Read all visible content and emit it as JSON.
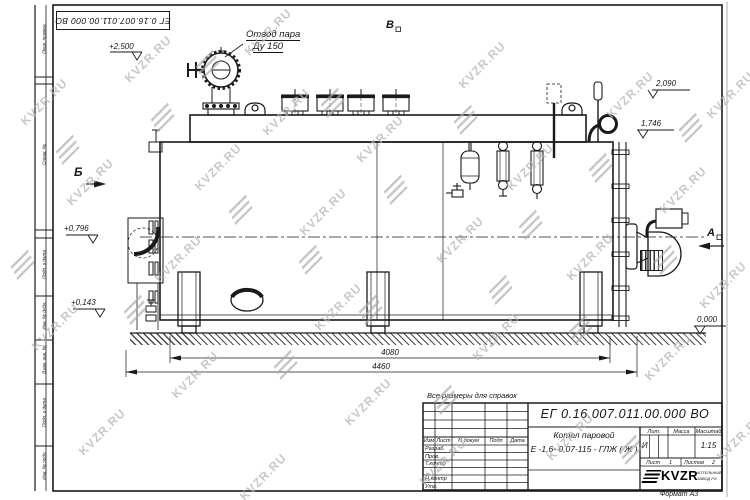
{
  "page": {
    "format": "Формат  А3"
  },
  "frame": {
    "top_designation": "ЕГ 0.16.007.011.00.000  ВО",
    "stamps": {
      "s1": "Перв. примен.",
      "s2": "Справ. №",
      "s3": "Подп. и дата",
      "s4": "Инв. № дубл.",
      "s5": "Взам. инв. №",
      "s6": "Подп. и дата",
      "s7": "Инв. № подл."
    }
  },
  "drawing": {
    "note": "Все размеры для справок",
    "steam_outlet": {
      "line1": "Отвод пара",
      "line2": "Ду 150"
    },
    "views": {
      "b": "Б",
      "v": "В",
      "a": "А"
    },
    "elevations": {
      "e2500": "+2,500",
      "e2090": "2,090",
      "e1746": "1,746",
      "e0796": "+0,796",
      "e0143": "+0,143",
      "e0000": "0,000"
    },
    "dims": {
      "d4080": "4080",
      "d4460": "4460"
    }
  },
  "title_block": {
    "designation": "ЕГ 0.16.007.011.00.000  ВО",
    "name1": "Котел паровой",
    "name2": "Е -1,6- 0,07-115 - ГЛЖ ( Ж )",
    "cols": {
      "izm": "Изм",
      "list": "Лист",
      "doc": "N докум",
      "podp": "Подп",
      "data": "Дата"
    },
    "rows": {
      "r1": "Разраб.",
      "r2": "Пров.",
      "r3": "Т.контр",
      "r4": "Н.контр",
      "r5": "Утв."
    },
    "lit": {
      "label": "Лит.",
      "value": "И"
    },
    "mass": {
      "label": "Масса"
    },
    "scale": {
      "label": "Масштаб",
      "value": "1:15"
    },
    "sheet": {
      "label": "Лист",
      "value": "1"
    },
    "sheets": {
      "label": "Листов",
      "value": "2"
    },
    "logo": {
      "text": "KVZR",
      "sub1": "КОТЕЛЬНЫЙ",
      "sub2": "ЗАВОД РЭ"
    }
  },
  "watermark": {
    "text": "KVZR.RU"
  }
}
